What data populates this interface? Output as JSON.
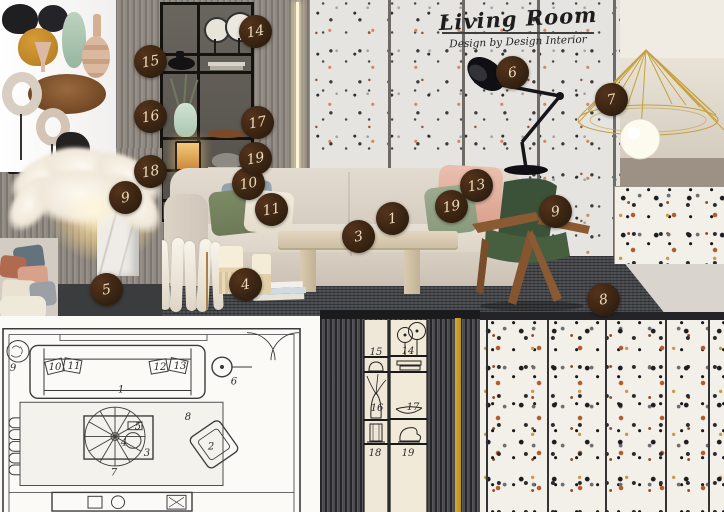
{
  "title": {
    "main": "Living Room",
    "byline": "Design by Design Interior"
  },
  "badges": {
    "sofa": "1",
    "coffee_table": "3",
    "candles_books": "4",
    "basket_tray": "5",
    "floor_lamp": "6",
    "pendant_lamp": "7",
    "rug": "8",
    "armchair": "9",
    "feather_lamp": "9",
    "pillow_blue": "10",
    "pillow_green": "11",
    "pillow_pink": "13",
    "pillow_sage": "19",
    "wall_clocks": "14",
    "black_vase": "15",
    "green_vase": "16",
    "wood_bowl": "17",
    "shelf_books": "19",
    "feather_plant": "18"
  },
  "floor_plan": {
    "sofa": "1",
    "armchair": "2",
    "coffee_table": "3",
    "table_decor": "4",
    "table_tray": "5",
    "floor_lamp": "6",
    "pendant": "7",
    "rug": "8",
    "plant": "9",
    "pillow_10": "10",
    "pillow_11": "11",
    "pillow_12": "12",
    "pillow_13": "13"
  },
  "elevation": {
    "clocks": "14",
    "vase": "15",
    "plant_vase": "16",
    "bowl": "17",
    "lamp": "18",
    "decor": "19"
  },
  "palette": {
    "badge_bg": "#33200f",
    "badge_text": "#ecdcbb",
    "gold": "#c9a23f",
    "armchair_green": "#41573d",
    "terrazzo_accent": "#b05c2e",
    "rug": "#46484c",
    "wood": "#8a5a33",
    "wall_gray": "#8f8981"
  }
}
